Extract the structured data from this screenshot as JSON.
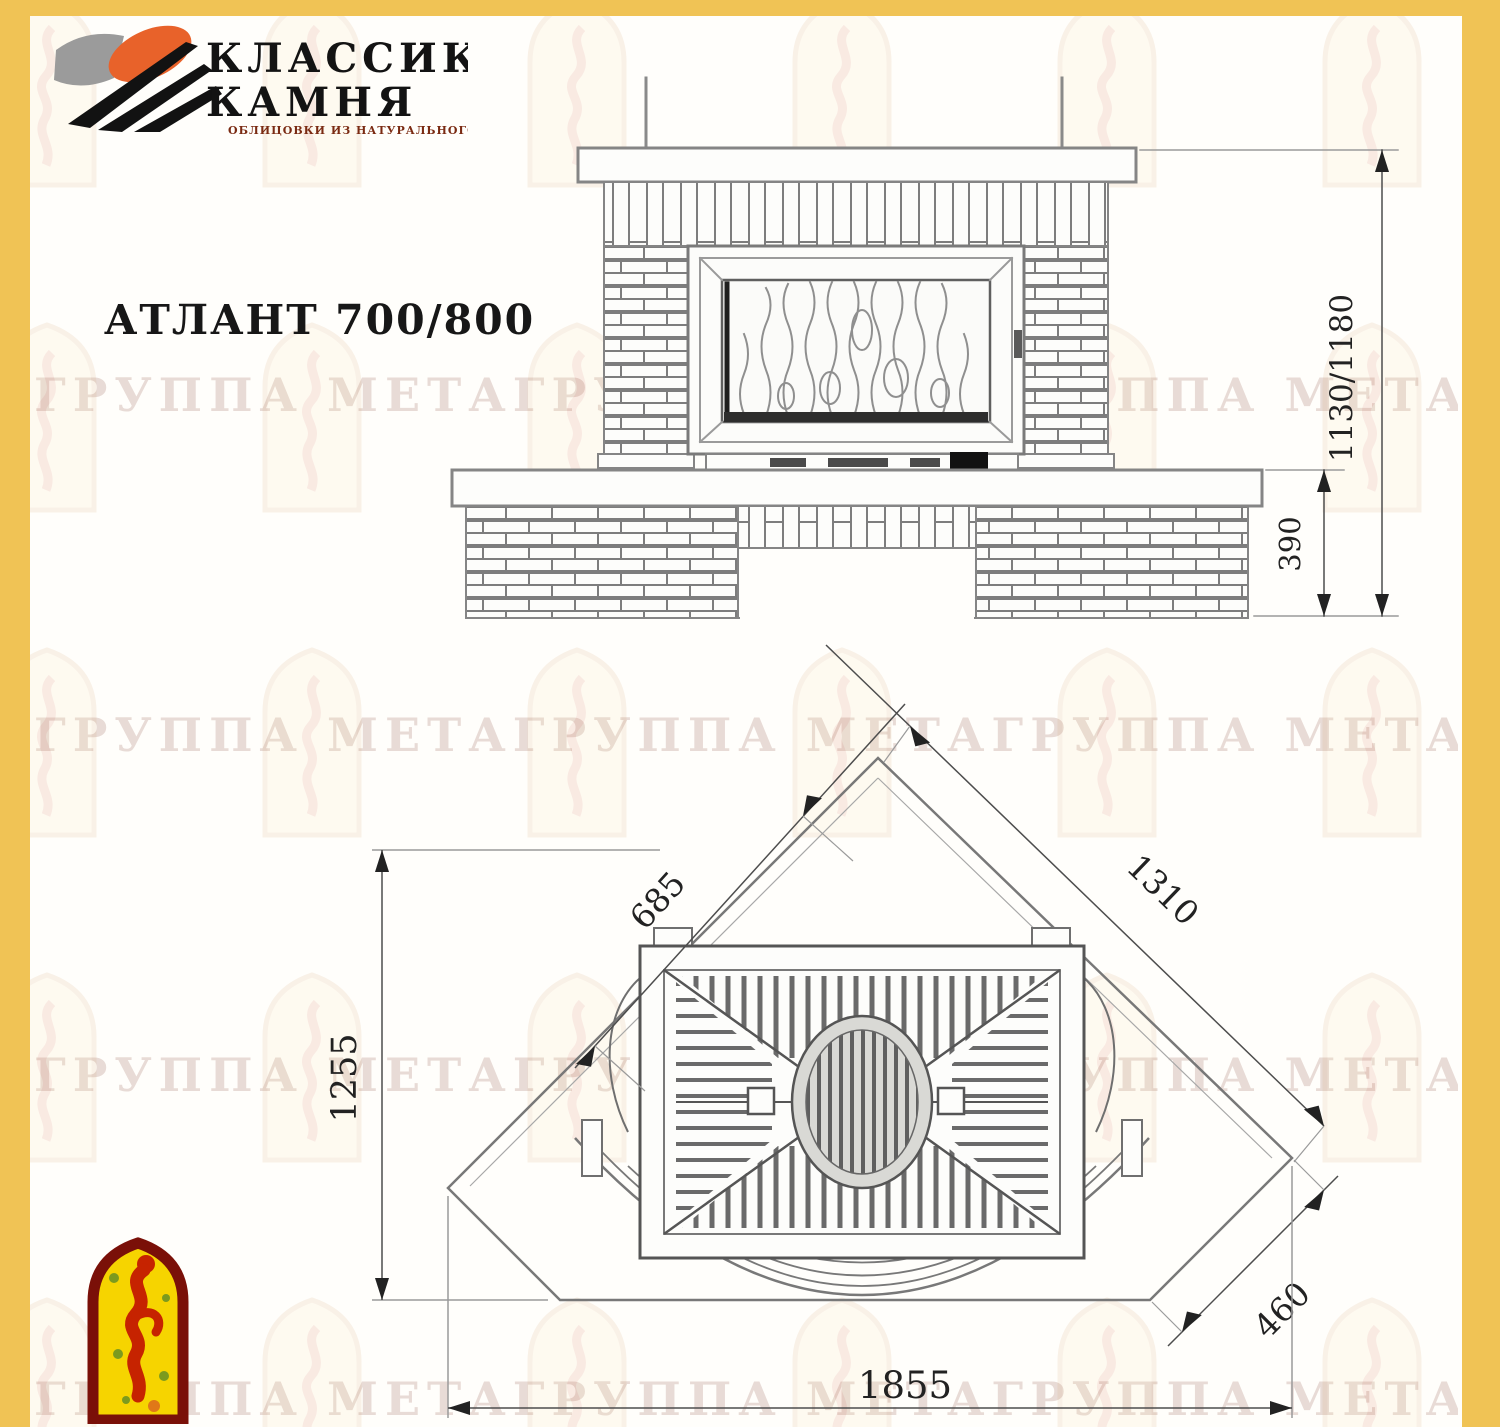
{
  "header": {
    "logo": {
      "line1": "КЛАССИКА",
      "line2": "КАМНЯ",
      "subtitle": "ОБЛИЦОВКИ ИЗ НАТУРАЛЬНОГО КАМНЯ"
    },
    "title": "АТЛАНТ 700/800"
  },
  "watermark": {
    "text": "ГРУППА МЕТАГРУППА МЕТАГРУППА МЕТА ГРУППА МЕТА"
  },
  "front_view": {
    "dim_total_height": "1130/1180",
    "dim_base_height": "390"
  },
  "plan_view": {
    "dim_left_face": "685",
    "dim_right_wall": "1310",
    "dim_depth": "1255",
    "dim_corner_face": "460",
    "dim_total_width": "1855"
  },
  "colors": {
    "border_yellow": "#f0c355",
    "line_gray": "#808080",
    "dark": "#1a1a1a",
    "logo_orange": "#e8622a",
    "emblem_red": "#c62300",
    "emblem_yellow": "#f6d400",
    "emblem_border": "#7a1008"
  }
}
